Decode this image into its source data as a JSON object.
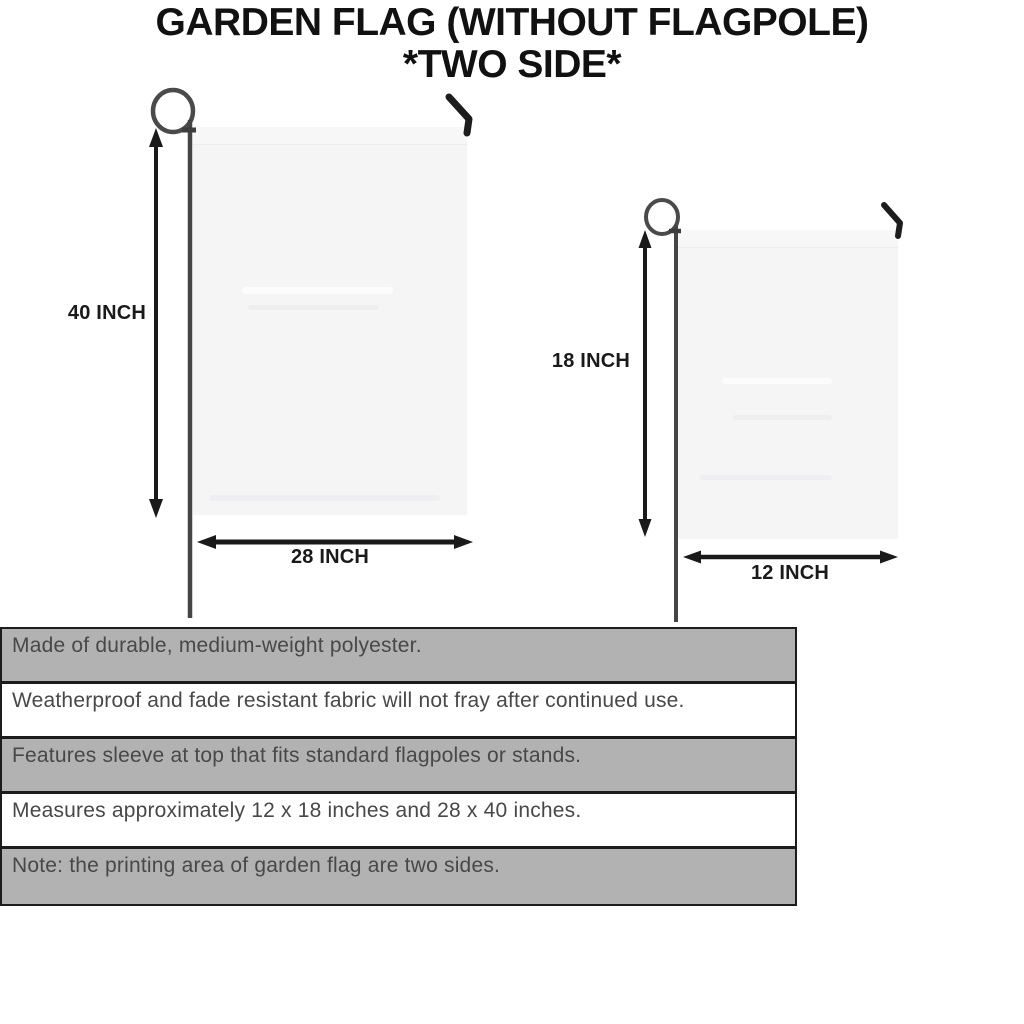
{
  "title": {
    "line1": "GARDEN FLAG (WITHOUT FLAGPOLE)",
    "line2": "*TWO SIDE*"
  },
  "flags": {
    "large": {
      "height_label": "40 INCH",
      "width_label": "28 INCH"
    },
    "small": {
      "height_label": "18 INCH",
      "width_label": "12 INCH"
    }
  },
  "features": [
    {
      "text": "Made of durable, medium-weight polyester.",
      "shaded": true
    },
    {
      "text": "Weatherproof and fade resistant fabric will not fray after continued use.",
      "shaded": false
    },
    {
      "text": "Features sleeve at top that fits standard flagpoles or stands.",
      "shaded": true
    },
    {
      "text": "Measures approximately 12 x 18 inches and 28 x 40 inches.",
      "shaded": false
    },
    {
      "text": "Note: the printing area of garden flag are two sides.",
      "shaded": true
    }
  ],
  "colors": {
    "ink": "#1a1a1a",
    "pole_gray": "#474747",
    "flag_fill": "#f5f5f6",
    "row_gray": "#b2b2b2",
    "feature_text": "#484848"
  }
}
